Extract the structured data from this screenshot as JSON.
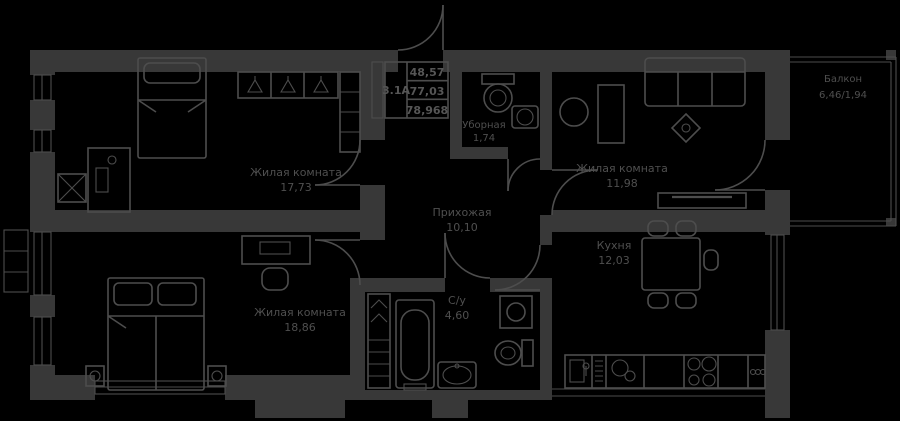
{
  "colors": {
    "background": "#000000",
    "walls": "#383838",
    "lines": "#4d4d4d",
    "text": "#4f4f4f"
  },
  "info_box": {
    "unit": "3.1А",
    "values": [
      "48,57",
      "77,03",
      "78,968"
    ]
  },
  "rooms": [
    {
      "name": "Жилая комната",
      "area": "17,73"
    },
    {
      "name": "Жилая комната",
      "area": "11,98"
    },
    {
      "name": "Жилая комната",
      "area": "18,86"
    },
    {
      "name": "Прихожая",
      "area": "10,10"
    },
    {
      "name": "Кухня",
      "area": "12,03"
    },
    {
      "name": "С/у",
      "area": "4,60"
    },
    {
      "name": "Уборная",
      "area": "1,74"
    },
    {
      "name": "Балкон",
      "area": "6,46/1,94"
    }
  ],
  "icon_names": [
    "bed-icon",
    "desk-icon",
    "chair-icon",
    "wardrobe-icon",
    "shelf-icon",
    "sofa-icon",
    "side-table-icon",
    "tv-stand-icon",
    "dining-table-icon",
    "kitchen-counter-icon",
    "sink-icon",
    "stove-icon",
    "dishwasher-icon",
    "bathtub-icon",
    "washing-machine-icon",
    "toilet-icon",
    "radiator-icon",
    "window-icon",
    "door-arc-icon",
    "hanger-icon"
  ]
}
